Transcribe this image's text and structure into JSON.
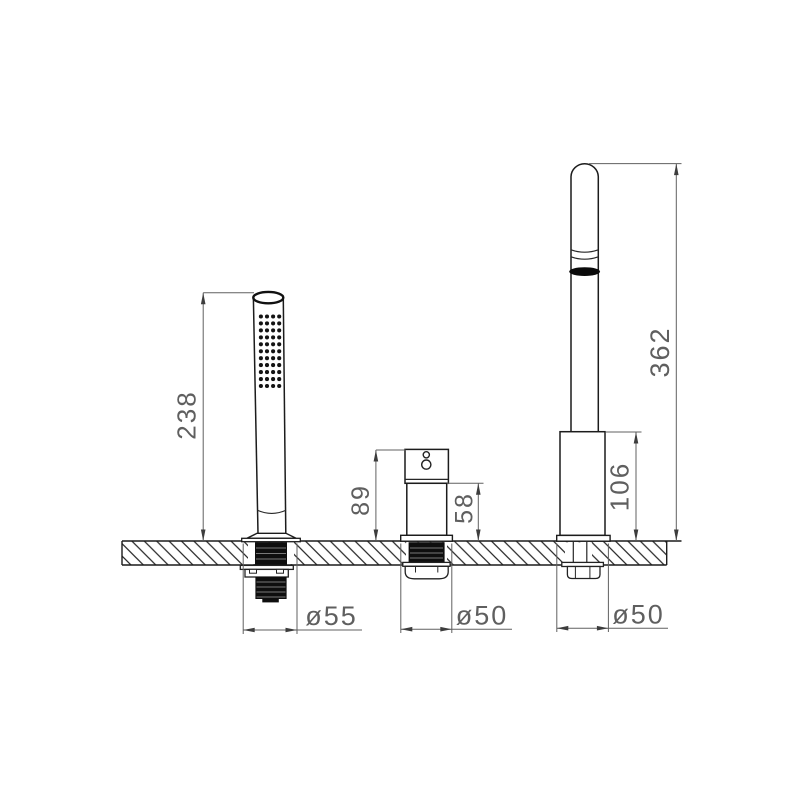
{
  "drawing": {
    "labels": {
      "hand_shower_height": "238",
      "diverter_total_height": "89",
      "diverter_body_height": "58",
      "spout_total_height": "362",
      "spout_base_height": "106",
      "hand_shower_base_dia": "ø55",
      "diverter_base_dia": "ø50",
      "spout_base_dia": "ø50"
    },
    "colors": {
      "object_line": "#1c1c1c",
      "dim_line": "#606060",
      "dim_text": "#5f5f5f",
      "dark_fill": "#0e0e0e",
      "background": "#ffffff"
    },
    "nozzle_grid": {
      "rows": 11,
      "cols": 4
    }
  }
}
